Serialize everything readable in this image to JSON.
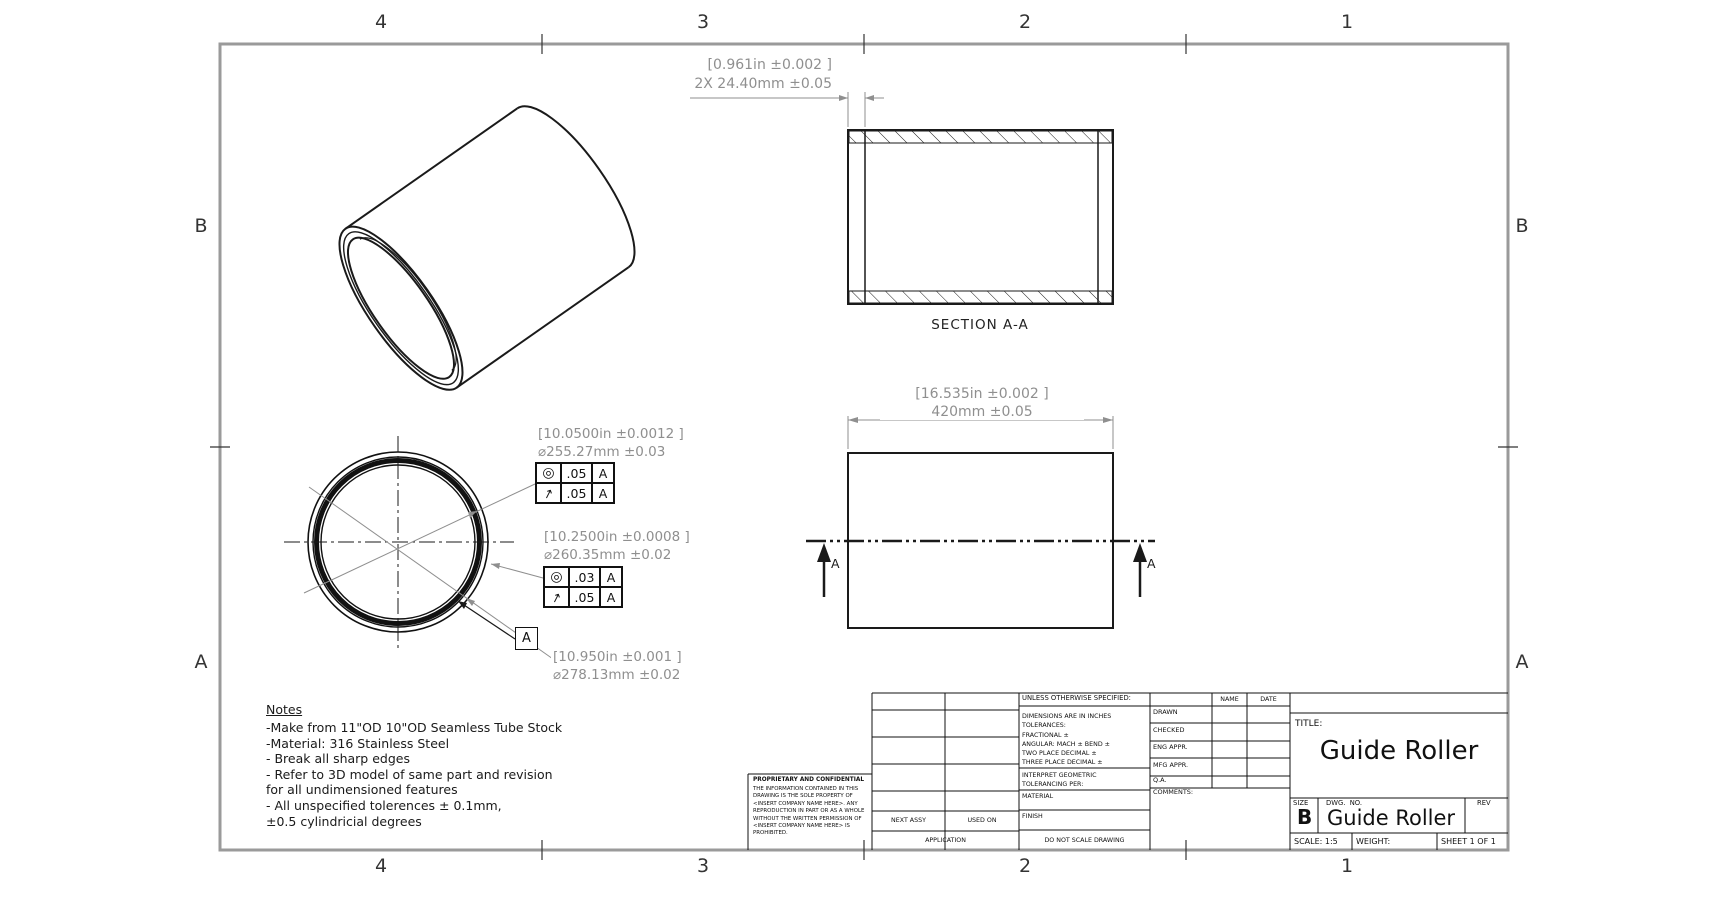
{
  "sheet": {
    "zones_h": [
      "4",
      "3",
      "2",
      "1"
    ],
    "zones_v": [
      "B",
      "A"
    ],
    "colors": {
      "line": "#1a1a1a",
      "dim_gray": "#8f8f8f",
      "border_gray": "#9a9a9a"
    }
  },
  "views": {
    "section": {
      "label": "SECTION A-A",
      "width_dim_in": "[0.961in ±0.002 ]",
      "width_dim_mm": "2X 24.40mm ±0.05"
    },
    "side": {
      "length_dim_in": "[16.535in ±0.002 ]",
      "length_dim_mm": "420mm ±0.05",
      "cut_label_left": "A",
      "cut_label_right": "A"
    },
    "front": {
      "callout_bore1_in": "[10.0500in ±0.0012 ]",
      "callout_bore1_mm": "⌀255.27mm ±0.03",
      "fcf1": {
        "r1_sym": "◎",
        "r1_val": ".05",
        "r1_datum": "A",
        "r2_sym": "↗",
        "r2_val": ".05",
        "r2_datum": "A"
      },
      "callout_bore2_in": "[10.2500in ±0.0008 ]",
      "callout_bore2_mm": "⌀260.35mm ±0.02",
      "fcf2": {
        "r1_sym": "◎",
        "r1_val": ".03",
        "r1_datum": "A",
        "r2_sym": "↗",
        "r2_val": ".05",
        "r2_datum": "A"
      },
      "datum_label": "A",
      "callout_od_in": "[10.950in ±0.001 ]",
      "callout_od_mm": "⌀278.13mm ±0.02"
    }
  },
  "notes": {
    "heading": "Notes",
    "body": "-Make from 11\"OD 10\"OD Seamless Tube Stock\n-Material: 316 Stainless Steel\n- Break all sharp edges\n- Refer to 3D model of same part and revision\nfor all undimensioned  features\n- All unspecified tolerences  ± 0.1mm,\n±0.5 cylindricial degrees"
  },
  "title_block": {
    "unless": "UNLESS OTHERWISE SPECIFIED:",
    "tolerances": "DIMENSIONS ARE IN INCHES\nTOLERANCES:\nFRACTIONAL ±\nANGULAR: MACH ±   BEND ±\nTWO PLACE DECIMAL    ±\nTHREE PLACE DECIMAL  ±",
    "interpret": "INTERPRET GEOMETRIC\nTOLERANCING PER:",
    "material_label": "MATERIAL",
    "finish_label": "FINISH",
    "do_not_scale": "DO NOT SCALE DRAWING",
    "name_col": "NAME",
    "date_col": "DATE",
    "rows": [
      "DRAWN",
      "CHECKED",
      "ENG APPR.",
      "MFG APPR.",
      "Q.A.",
      "COMMENTS:"
    ],
    "title_label": "TITLE:",
    "title": "Guide Roller",
    "size_label": "SIZE",
    "size": "B",
    "dwg_label": "DWG.  NO.",
    "dwg_no": "Guide Roller",
    "rev_label": "REV",
    "scale": "SCALE: 1:5",
    "weight": "WEIGHT:",
    "sheet": "SHEET 1 OF 1",
    "next_assy": "NEXT ASSY",
    "used_on": "USED ON",
    "application": "APPLICATION",
    "proprietary_heading": "PROPRIETARY AND CONFIDENTIAL",
    "proprietary_body": "THE INFORMATION CONTAINED IN THIS\nDRAWING IS THE SOLE PROPERTY OF\n<INSERT COMPANY NAME HERE>.  ANY\nREPRODUCTION IN PART OR AS A WHOLE\nWITHOUT THE WRITTEN PERMISSION OF\n<INSERT COMPANY NAME HERE> IS\nPROHIBITED."
  }
}
